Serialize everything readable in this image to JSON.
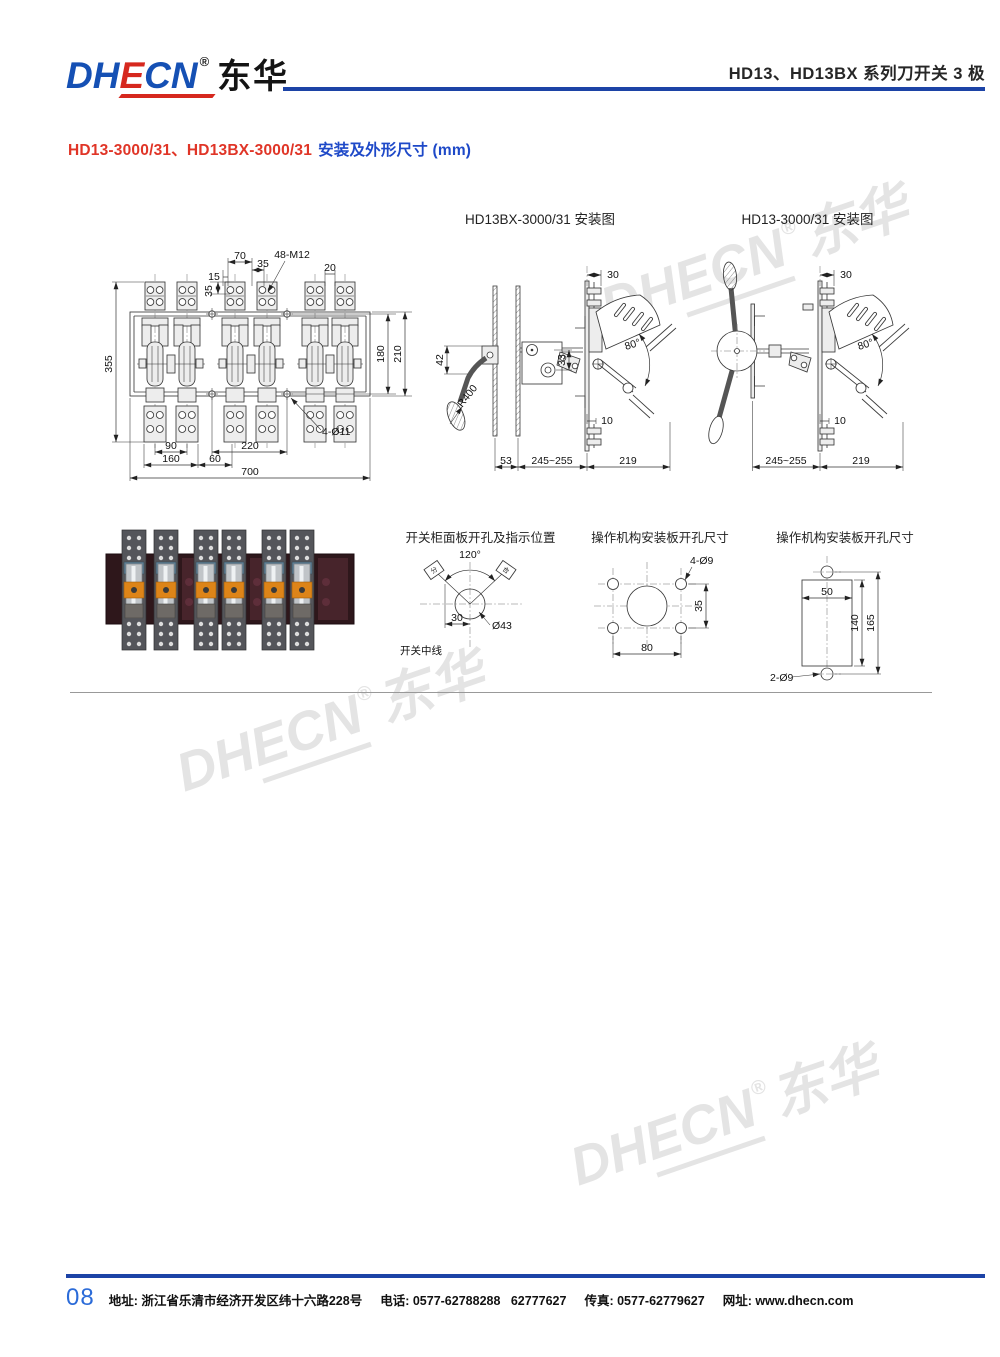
{
  "header": {
    "logo": {
      "dh": "DH",
      "e": "E",
      "cn": "CN",
      "reg": "®",
      "cjk": "东华"
    },
    "title": "HD13、HD13BX 系列刀开关 3 极"
  },
  "subtitle": {
    "models": "HD13-3000/31、HD13BX-3000/31",
    "desc": "安装及外形尺寸 (mm)"
  },
  "watermark": {
    "dh": "DH",
    "ecn": "ECN",
    "reg": "®",
    "cjk": "东华"
  },
  "front_view": {
    "dims": {
      "d70": "70",
      "d35a": "35",
      "d15": "15",
      "d35b": "35",
      "bolts": "48-M12",
      "d20": "20",
      "d355": "355",
      "d180": "180",
      "d210": "210",
      "d90": "90",
      "d220": "220",
      "holes": "4-Ø11",
      "d160": "160",
      "d60": "60",
      "d700": "700"
    }
  },
  "bx_view": {
    "title": "HD13BX-3000/31 安装图",
    "dims": {
      "d30": "30",
      "d42": "42",
      "r400": "R400",
      "d33": "33",
      "a80": "80°",
      "d10": "10",
      "d53": "53",
      "d245": "245~255",
      "d219": "219"
    }
  },
  "hd_view": {
    "title": "HD13-3000/31 安装图",
    "dims": {
      "d30": "30",
      "a80": "80°",
      "d10": "10",
      "d245": "245~255",
      "d219": "219"
    }
  },
  "panel_view": {
    "title": "开关柜面板开孔及指示位置",
    "dims": {
      "a120": "120°",
      "d30": "30",
      "dia": "Ø43",
      "centerline": "开关中线",
      "ind_left": "分",
      "ind_right": "合"
    }
  },
  "mount4_view": {
    "title": "操作机构安装板开孔尺寸",
    "dims": {
      "holes": "4-Ø9",
      "d35": "35",
      "d80": "80"
    }
  },
  "mount2_view": {
    "title": "操作机构安装板开孔尺寸",
    "dims": {
      "d50": "50",
      "d140": "140",
      "d165": "165",
      "holes": "2-Ø9"
    }
  },
  "footer": {
    "page": "08",
    "segments": [
      "地址: 浙江省乐清市经济开发区纬十六路228号",
      "电话: 0577-62788288   62777627",
      "传真: 0577-62779627",
      "网址: www.dhecn.com"
    ]
  },
  "colors": {
    "accent_blue": "#1c43a6",
    "logo_red": "#d6281e",
    "watermark_gray": "#e4e4e4"
  }
}
